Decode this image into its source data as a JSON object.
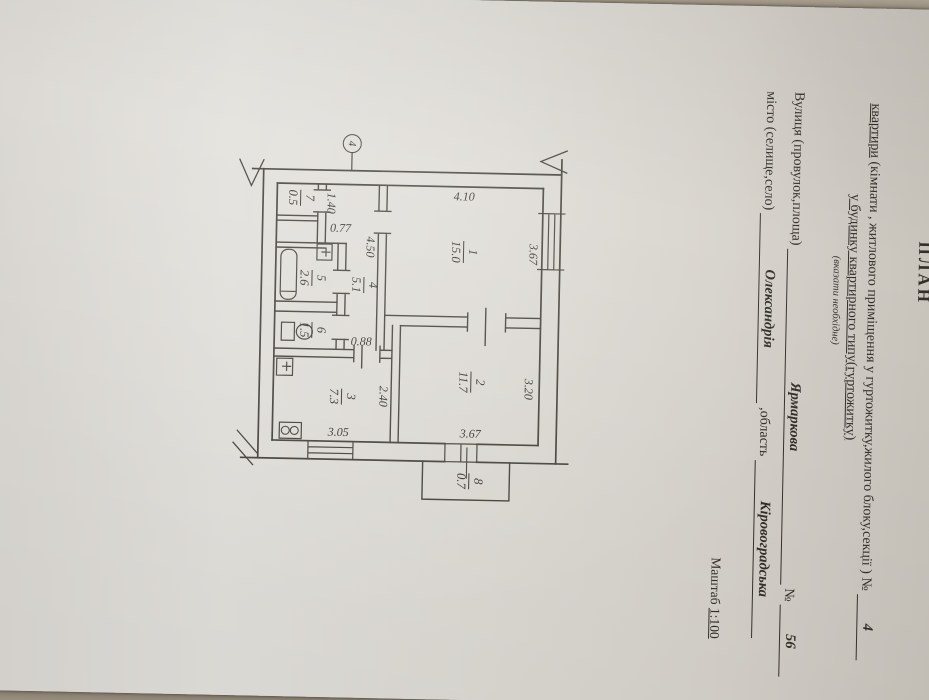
{
  "header": {
    "title": "ПЛАН",
    "line1_word": "квартири",
    "line1_rest": " (кімнати , житлового приміщення у гуртожитку,жилого блоку,секції ) ",
    "line1_no": "№",
    "line1_value": "4",
    "line2": "у будинку квартирного типу(гуртожитку)",
    "line2_note": "(вказати необхідне)",
    "line3_label": "Вулиця (провулок,площа)",
    "line3_value": "Ярмаркова",
    "line3_no": "№",
    "line3_num": "56",
    "line4_label": "місто (селище,село)",
    "line4_value": "Олександрія",
    "line4_label2": ",область",
    "line4_value2": "Кіровоградська",
    "scale_label": "Маштаб",
    "scale_value": "1:100"
  },
  "plan": {
    "axis_marker": "4",
    "rooms": [
      {
        "number": "1",
        "area": "15.0"
      },
      {
        "number": "2",
        "area": "11.7"
      },
      {
        "number": "3",
        "area": "7.3"
      },
      {
        "number": "4",
        "area": "5.1"
      },
      {
        "number": "5",
        "area": "2.6"
      },
      {
        "number": "6",
        "area": "1.5"
      },
      {
        "number": "7",
        "area": "0.5"
      },
      {
        "number": "8",
        "area": "0.7"
      }
    ],
    "dims": {
      "d410": "4.10",
      "d367a": "3.67",
      "d320": "3.20",
      "d367b": "3.67",
      "d240": "2.40",
      "d305": "3.05",
      "d450": "4.50",
      "d077": "0.77",
      "d088": "0.88",
      "d140": "1.40"
    },
    "line_color": "#46423b"
  }
}
